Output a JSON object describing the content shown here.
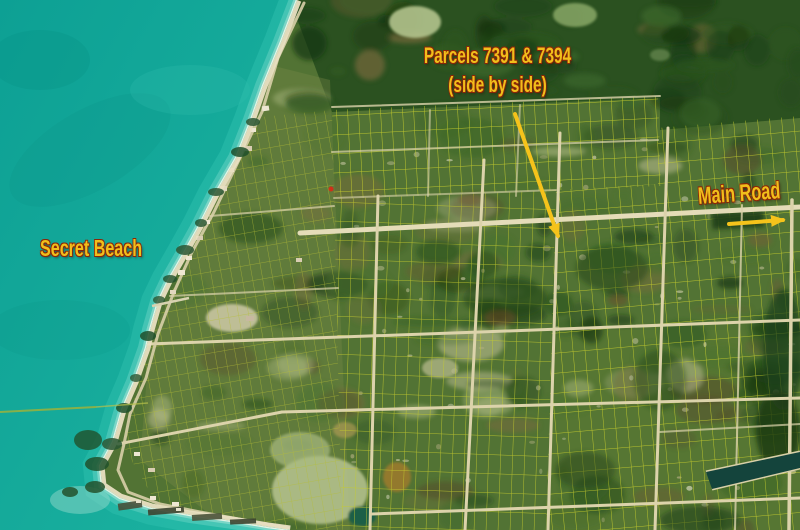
{
  "title": "Secret Beach aerial parcel map",
  "annotations": {
    "parcels_label": {
      "line1": "Parcels 7391 & 7394",
      "line2": "(side by side)"
    },
    "beach_label": "Secret Beach",
    "road_label": "Main Road"
  },
  "icons": {
    "parcel_arrow": "arrow-down-right-to-parcels",
    "road_arrow": "arrow-right-along-main-road"
  },
  "colors": {
    "annotation_text": "#f0bf1b",
    "annotation_outline": "#8c2508",
    "arrow": "#f5c31b",
    "water_deep": "#0da094",
    "water_shallow": "#5ecfbf",
    "foam": "#f2f6e8",
    "beach_sand": "#e9dfc2",
    "vegetation_base": "#527334",
    "forest_dark": "#2b5120",
    "parcel_line_yellow": "#c6cc2e",
    "road_tan": "#dcd3ab"
  }
}
